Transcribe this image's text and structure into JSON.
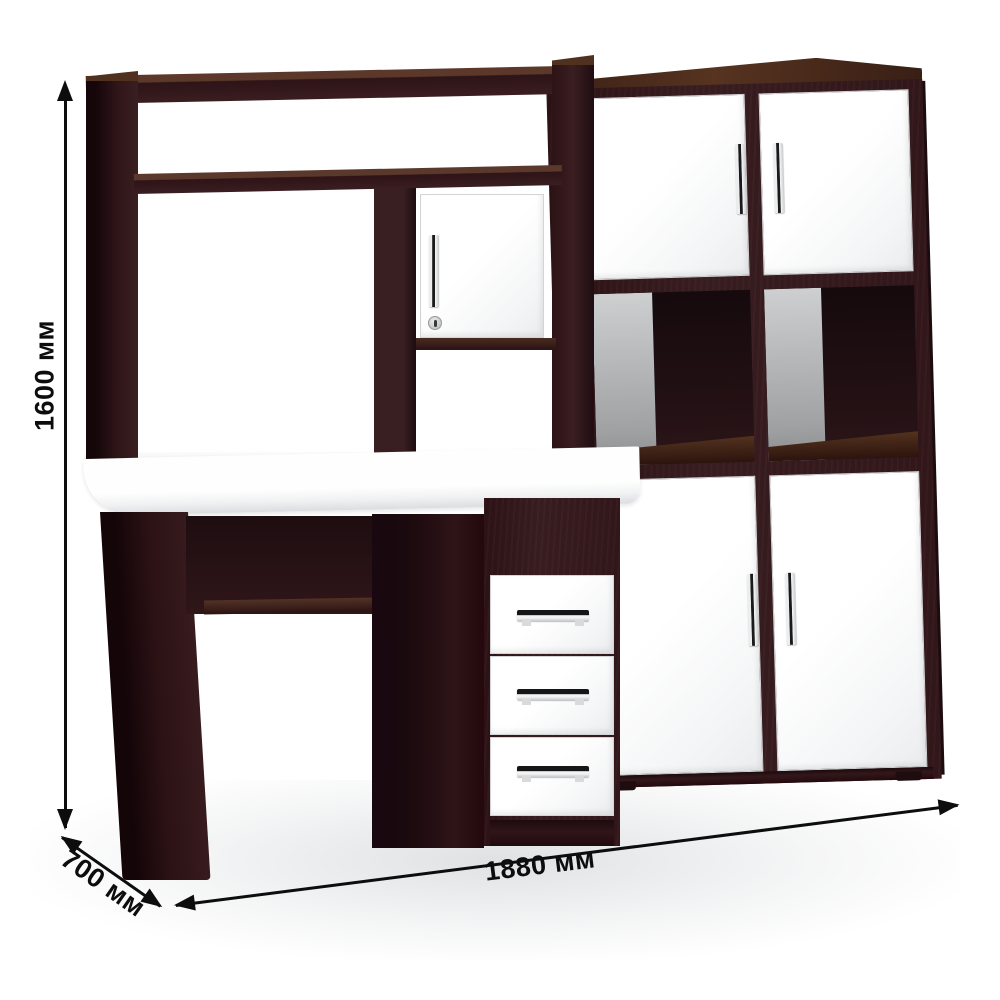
{
  "product": {
    "type": "computer-desk-with-hutch-and-shelving-cabinet",
    "finish": "wenge-and-white"
  },
  "dimensions": {
    "height_label": "1600 мм",
    "depth_label": "700 мм",
    "width_label": "1880 мм"
  },
  "colors": {
    "background": "#ffffff",
    "wenge_front": "#381d20",
    "wenge_dark": "#200e12",
    "wenge_top": "#543120",
    "interior_dark": "#1c0d10",
    "interior_gray": "#b6b8ba",
    "panel_white": "#fdfdfd",
    "panel_edge": "#d6d7d9",
    "chrome": "#eceded",
    "handle_dark": "#1a1a1a",
    "dimension_ink": "#0d0d0d",
    "floor_shadow": "#dfe1e3"
  }
}
